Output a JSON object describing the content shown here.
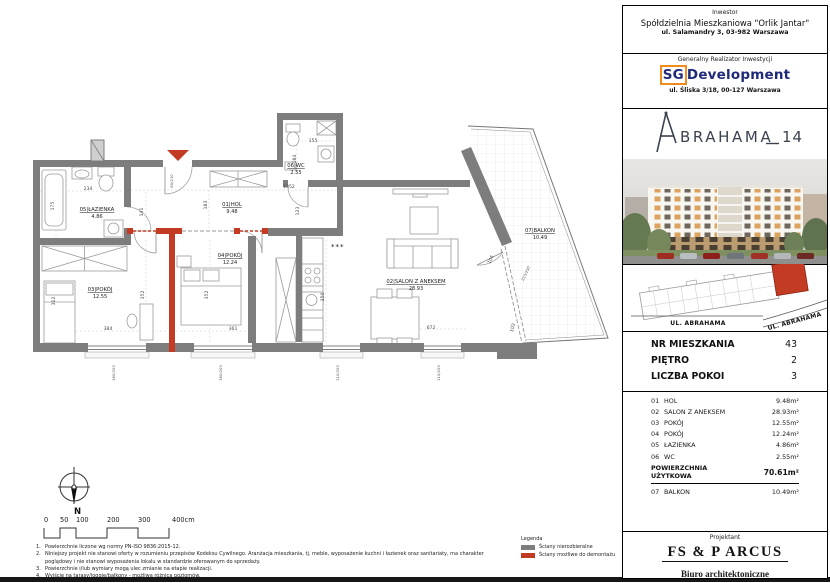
{
  "colors": {
    "wall_gray": "#7d7d7d",
    "wall_red": "#c23b22",
    "sg_navy": "#202a7a",
    "sg_orange": "#f08c1e",
    "brand_dark": "#39424e"
  },
  "header": {
    "investor": {
      "label": "Inwestor",
      "name": "Spółdzielnia Mieszkaniowa \"Orlik Jantar\"",
      "address": "ul. Salamandry 3, 03-982 Warszawa"
    },
    "developer": {
      "label": "Generalny Realizator Inwestycji",
      "logo_sg": "SG",
      "logo_rest": "Development",
      "address": "ul. Śliska 3/18, 00-127 Warszawa"
    },
    "project": {
      "name_rest": "BRAHAMA",
      "number": "14"
    }
  },
  "locator": {
    "street_left": "UL. ABRAHAMA",
    "street_right": "UL. ABRAHAMA"
  },
  "unit": {
    "info_rows": [
      {
        "label": "NR MIESZKANIA",
        "value": "43"
      },
      {
        "label": "PIĘTRO",
        "value": "2"
      },
      {
        "label": "LICZBA POKOI",
        "value": "3"
      }
    ],
    "rooms": [
      {
        "no": "01",
        "name": "HOL",
        "area": "9.48m²"
      },
      {
        "no": "02",
        "name": "SALON Z ANEKSEM",
        "area": "28.93m²"
      },
      {
        "no": "03",
        "name": "POKÓJ",
        "area": "12.55m²"
      },
      {
        "no": "04",
        "name": "POKÓJ",
        "area": "12.24m²"
      },
      {
        "no": "05",
        "name": "ŁAZIENKA",
        "area": "4.86m²"
      },
      {
        "no": "06",
        "name": "WC",
        "area": "2.55m²"
      }
    ],
    "total": {
      "label1": "POWIERZCHNIA",
      "label2": "UŻYTKOWA",
      "value": "70.61m²"
    },
    "balcony": {
      "no": "07",
      "name": "BALKON",
      "area": "10.49m²"
    }
  },
  "designer": {
    "label": "Projektant",
    "name": "FS & P ARCUS",
    "subtitle": "Biuro architektoniczne",
    "address1": "ul. gen. Abrahama 12 lok. 92 | 03-982 Warszawa",
    "address2": "www.fsparcus.com.pl | fsparcus@fsparcus.com.pl"
  },
  "plan": {
    "legend": {
      "title": "Legenda",
      "items": [
        {
          "label": "Ściany nierozbieralne",
          "color": "#7d7d7d"
        },
        {
          "label": "Ściany możliwe do demontażu",
          "color": "#c23b22"
        }
      ]
    },
    "notes": [
      {
        "n": "1.",
        "text": "Powierzchnie liczone wg normy PN-ISO 9836:2015-12."
      },
      {
        "n": "2.",
        "text": "Niniejszy projekt nie stanowi oferty w rozumieniu przepisów Kodeksu Cywilnego. Aranżacja mieszkania, tj. meble, wyposażenie kuchni i łazienek oraz sanitariaty, ma charakter poglądowy i nie stanowi wyposażenia lokalu w standardzie oferowanym do sprzedaży."
      },
      {
        "n": "3.",
        "text": "Powierzchnie i/lub wymiary mogą ulec zmianie na etapie realizacji."
      },
      {
        "n": "4.",
        "text": "Wyjście na tarasy/loggie/balkony - możliwa różnica poziomów."
      }
    ],
    "room_labels": [
      {
        "no": "05",
        "name": "ŁAZIENKA",
        "area": "4.86",
        "x": 97,
        "y": 211
      },
      {
        "no": "01",
        "name": "HOL",
        "area": "9.48",
        "x": 232,
        "y": 206
      },
      {
        "no": "06",
        "name": "WC",
        "area": "2.55",
        "x": 296,
        "y": 167
      },
      {
        "no": "03",
        "name": "POKÓJ",
        "area": "12.55",
        "x": 100,
        "y": 291
      },
      {
        "no": "04",
        "name": "POKÓJ",
        "area": "12.24",
        "x": 230,
        "y": 257
      },
      {
        "no": "02",
        "name": "SALON Z ANEKSEM",
        "area": "28.93",
        "x": 416,
        "y": 283
      },
      {
        "no": "07",
        "name": "BALKON",
        "area": "10.49",
        "x": 540,
        "y": 232
      }
    ],
    "labels": [
      {
        "t": "234",
        "x": 88,
        "y": 190
      },
      {
        "t": "175",
        "x": 54,
        "y": 206,
        "r": -90
      },
      {
        "t": "80/210",
        "x": 173,
        "y": 181,
        "r": -90,
        "cls": "dim win"
      },
      {
        "t": "141",
        "x": 143,
        "y": 212,
        "r": -90
      },
      {
        "t": "183",
        "x": 207,
        "y": 205,
        "r": -90
      },
      {
        "t": "1052",
        "x": 289,
        "y": 188
      },
      {
        "t": "123",
        "x": 299,
        "y": 211,
        "r": -90
      },
      {
        "t": "155",
        "x": 313,
        "y": 142
      },
      {
        "t": "184",
        "x": 296,
        "y": 159,
        "r": -90
      },
      {
        "t": "352",
        "x": 144,
        "y": 295,
        "r": -90
      },
      {
        "t": "352",
        "x": 208,
        "y": 295,
        "r": -90
      },
      {
        "t": "312",
        "x": 55,
        "y": 301,
        "r": -90
      },
      {
        "t": "384",
        "x": 108,
        "y": 330
      },
      {
        "t": "361",
        "x": 233,
        "y": 330
      },
      {
        "t": "350",
        "x": 324,
        "y": 297,
        "r": -90
      },
      {
        "t": "672",
        "x": 431,
        "y": 329
      },
      {
        "t": "105",
        "x": 492,
        "y": 260,
        "r": -65
      },
      {
        "t": "215/230",
        "x": 527,
        "y": 274,
        "r": -65,
        "cls": "dim win"
      },
      {
        "t": "103",
        "x": 514,
        "y": 328,
        "r": -75
      },
      {
        "t": "160/200",
        "x": 115,
        "y": 373,
        "r": -90,
        "cls": "dim win"
      },
      {
        "t": "160/200",
        "x": 222,
        "y": 373,
        "r": -90,
        "cls": "dim win"
      },
      {
        "t": "110/200",
        "x": 339,
        "y": 373,
        "r": -90,
        "cls": "dim win"
      },
      {
        "t": "110/200",
        "x": 440,
        "y": 373,
        "r": -90,
        "cls": "dim win"
      },
      {
        "t": "0",
        "x": 44,
        "y": 522,
        "cls": "scale"
      },
      {
        "t": "50",
        "x": 60,
        "y": 522,
        "cls": "scale"
      },
      {
        "t": "100",
        "x": 76,
        "y": 522,
        "cls": "scale"
      },
      {
        "t": "200",
        "x": 107,
        "y": 522,
        "cls": "scale"
      },
      {
        "t": "300",
        "x": 138,
        "y": 522,
        "cls": "scale"
      },
      {
        "t": "400cm",
        "x": 172,
        "y": 522,
        "cls": "scale"
      },
      {
        "t": "N",
        "x": 74,
        "y": 514,
        "cls": "compassN"
      },
      {
        "t": "***",
        "x": 331,
        "y": 249,
        "cls": "stars"
      }
    ]
  }
}
